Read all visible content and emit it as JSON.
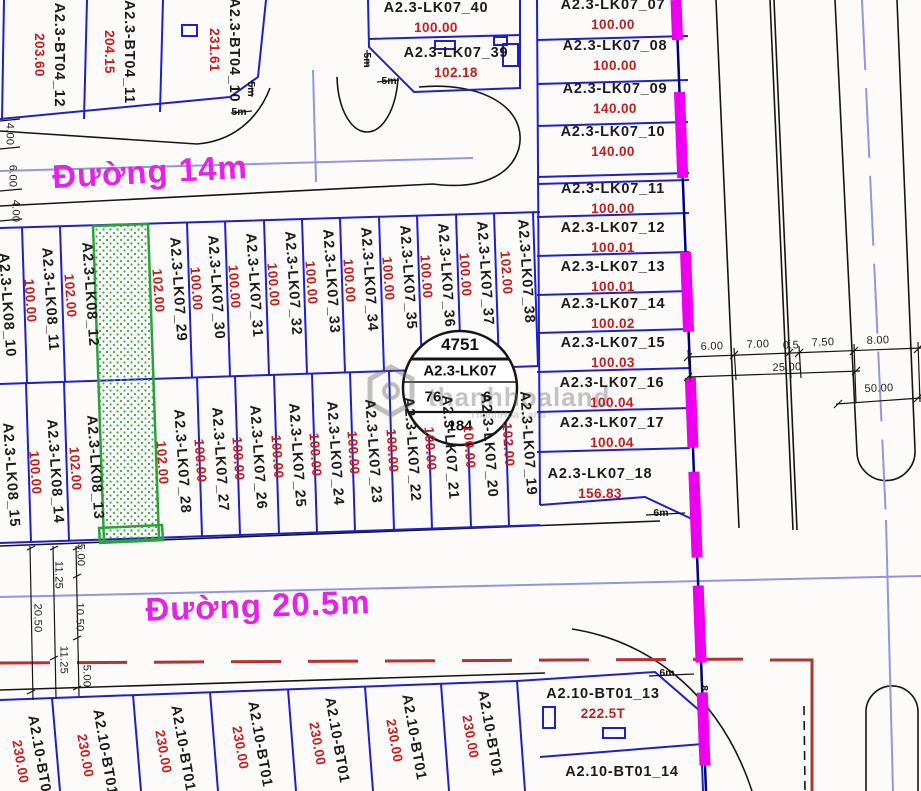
{
  "map": {
    "streets": {
      "road_14m": "Đường 14m",
      "road_20_5m": "Đường 20.5m"
    },
    "stamp": {
      "number": "4751",
      "block_name": "A2.3-LK07",
      "left_value": "76",
      "right_value": "6",
      "bottom_value": "184"
    },
    "watermark": {
      "main": "thanhhoaland",
      "sub": "ThanhHoa Land"
    },
    "colors": {
      "plot_line": "#2020c8",
      "area_text": "#c41e1e",
      "street_text": "#e424e4",
      "boundary_dash": "#ee00ee",
      "centerline": "#9595dd",
      "setback_line": "#b63232",
      "greenway": "#2aa23a"
    },
    "plot_labels": [
      {
        "label": "A2.3-BT04_12",
        "area": "203.60",
        "x": 49,
        "y": 55,
        "rot": 90
      },
      {
        "label": "A2.3-BT04_11",
        "area": "204.15",
        "x": 119,
        "y": 52,
        "rot": 90
      },
      {
        "label": "A2.3-BT04_10",
        "area": "231.61",
        "x": 224,
        "y": 50,
        "rot": 90
      },
      {
        "label": "A2.3-LK07_40",
        "area": "100.00",
        "x": 436,
        "y": 18,
        "rot": 0
      },
      {
        "label": "A2.3-LK07_39",
        "area": "102.18",
        "x": 456,
        "y": 63,
        "rot": 0
      },
      {
        "label": "A2.3-LK07_07",
        "area": "100.00",
        "x": 613,
        "y": 15,
        "rot": 0
      },
      {
        "label": "A2.3-LK07_08",
        "area": "100.00",
        "x": 615,
        "y": 56,
        "rot": 0
      },
      {
        "label": "A2.3-LK07_09",
        "area": "140.00",
        "x": 615,
        "y": 99,
        "rot": 0
      },
      {
        "label": "A2.3-LK07_10",
        "area": "140.00",
        "x": 613,
        "y": 142,
        "rot": 0
      },
      {
        "label": "A2.3-LK07_11",
        "area": "100.00",
        "x": 613,
        "y": 199,
        "rot": 0
      },
      {
        "label": "A2.3-LK07_12",
        "area": "100.01",
        "x": 613,
        "y": 238,
        "rot": 0
      },
      {
        "label": "A2.3-LK07_13",
        "area": "100.01",
        "x": 613,
        "y": 277,
        "rot": 0
      },
      {
        "label": "A2.3-LK07_14",
        "area": "100.02",
        "x": 613,
        "y": 314,
        "rot": 0
      },
      {
        "label": "A2.3-LK07_15",
        "area": "100.03",
        "x": 613,
        "y": 353,
        "rot": 0
      },
      {
        "label": "A2.3-LK07_16",
        "area": "100.04",
        "x": 612,
        "y": 393,
        "rot": 0
      },
      {
        "label": "A2.3-LK07_17",
        "area": "100.04",
        "x": 612,
        "y": 433,
        "rot": 0
      },
      {
        "label": "A2.3-LK07_18",
        "area": "156.83",
        "x": 600,
        "y": 484,
        "rot": 0
      },
      {
        "label": "A2.3-LK08_10",
        "area": "",
        "x": 6,
        "y": 305,
        "rot": 86
      },
      {
        "label": "A2.3-LK08_11",
        "area": "100.00",
        "x": 40,
        "y": 300,
        "rot": 86
      },
      {
        "label": "A2.3-LK08_12",
        "area": "102.00",
        "x": 80,
        "y": 295,
        "rot": 86
      },
      {
        "label": "A2.3-LK07_29",
        "area": "102.00",
        "x": 168,
        "y": 290,
        "rot": 86
      },
      {
        "label": "A2.3-LK07_30",
        "area": "100.00",
        "x": 206,
        "y": 288,
        "rot": 86
      },
      {
        "label": "A2.3-LK07_31",
        "area": "100.00",
        "x": 244,
        "y": 286,
        "rot": 86
      },
      {
        "label": "A2.3-LK07_32",
        "area": "100.00",
        "x": 283,
        "y": 284,
        "rot": 86
      },
      {
        "label": "A2.3-LK07_33",
        "area": "100.00",
        "x": 321,
        "y": 282,
        "rot": 86
      },
      {
        "label": "A2.3-LK07_34",
        "area": "100.00",
        "x": 359,
        "y": 280,
        "rot": 86
      },
      {
        "label": "A2.3-LK07_35",
        "area": "100.00",
        "x": 398,
        "y": 278,
        "rot": 86
      },
      {
        "label": "A2.3-LK07_36",
        "area": "100.00",
        "x": 436,
        "y": 276,
        "rot": 86
      },
      {
        "label": "A2.3-LK07_37",
        "area": "100.00",
        "x": 475,
        "y": 274,
        "rot": 86
      },
      {
        "label": "A2.3-LK07_38",
        "area": "102.00",
        "x": 516,
        "y": 272,
        "rot": 86
      },
      {
        "label": "A2.3-LK08_15",
        "area": "",
        "x": 10,
        "y": 475,
        "rot": 86
      },
      {
        "label": "A2.3-LK08_14",
        "area": "100.00",
        "x": 45,
        "y": 472,
        "rot": 86
      },
      {
        "label": "A2.3-LK08_13",
        "area": "102.00",
        "x": 85,
        "y": 468,
        "rot": 86
      },
      {
        "label": "A2.3-LK07_28",
        "area": "102.00",
        "x": 172,
        "y": 462,
        "rot": 86
      },
      {
        "label": "A2.3-LK07_27",
        "area": "100.00",
        "x": 210,
        "y": 460,
        "rot": 86
      },
      {
        "label": "A2.3-LK07_26",
        "area": "100.00",
        "x": 248,
        "y": 458,
        "rot": 86
      },
      {
        "label": "A2.3-LK07_25",
        "area": "100.00",
        "x": 287,
        "y": 456,
        "rot": 86
      },
      {
        "label": "A2.3-LK07_24",
        "area": "100.00",
        "x": 325,
        "y": 454,
        "rot": 86
      },
      {
        "label": "A2.3-LK07_23",
        "area": "100.00",
        "x": 363,
        "y": 452,
        "rot": 86
      },
      {
        "label": "A2.3-LK07_22",
        "area": "100.00",
        "x": 402,
        "y": 450,
        "rot": 86
      },
      {
        "label": "A2.3-LK07_21",
        "area": "100.00",
        "x": 440,
        "y": 448,
        "rot": 86
      },
      {
        "label": "A2.3-LK07_20",
        "area": "100.00",
        "x": 479,
        "y": 446,
        "rot": 86
      },
      {
        "label": "A2.3-LK07_19",
        "area": "102.00",
        "x": 518,
        "y": 444,
        "rot": 86
      },
      {
        "label": "A2.10-BT01",
        "area": "230.00",
        "x": 30,
        "y": 760,
        "rot": 80
      },
      {
        "label": "A2.10-BT01",
        "area": "230.00",
        "x": 95,
        "y": 754,
        "rot": 80
      },
      {
        "label": "A2.10-BT01",
        "area": "230.00",
        "x": 173,
        "y": 750,
        "rot": 80
      },
      {
        "label": "A2.10-BT01",
        "area": "230.00",
        "x": 250,
        "y": 746,
        "rot": 80
      },
      {
        "label": "A2.10-BT01",
        "area": "230.00",
        "x": 327,
        "y": 742,
        "rot": 80
      },
      {
        "label": "A2.10-BT01",
        "area": "230.00",
        "x": 404,
        "y": 739,
        "rot": 80
      },
      {
        "label": "A2.10-BT01",
        "area": "230.00",
        "x": 480,
        "y": 735,
        "rot": 80
      },
      {
        "label": "A2.10-BT01_13",
        "area": "222.5T",
        "x": 603,
        "y": 704,
        "rot": 0
      },
      {
        "label": "A2.10-BT01_14",
        "area": "",
        "x": 622,
        "y": 773,
        "rot": 0
      }
    ],
    "dimensions": [
      {
        "t": "4.00",
        "x": 9,
        "y": 134,
        "r": 90
      },
      {
        "t": "6.00",
        "x": 12,
        "y": 176,
        "r": 90
      },
      {
        "t": "4.00",
        "x": 15,
        "y": 211,
        "r": 90
      },
      {
        "t": "5.00",
        "x": 80,
        "y": 555,
        "r": 90
      },
      {
        "t": "11.25",
        "x": 58,
        "y": 575,
        "r": 90
      },
      {
        "t": "10.50",
        "x": 79,
        "y": 617,
        "r": 90
      },
      {
        "t": "20.50",
        "x": 37,
        "y": 618,
        "r": 90
      },
      {
        "t": "11.25",
        "x": 63,
        "y": 660,
        "r": 90
      },
      {
        "t": "5.00",
        "x": 86,
        "y": 676,
        "r": 90
      },
      {
        "t": "6.00",
        "x": 712,
        "y": 347,
        "r": -2
      },
      {
        "t": "7.00",
        "x": 758,
        "y": 345,
        "r": -2
      },
      {
        "t": "0.5",
        "x": 791,
        "y": 346,
        "r": -2
      },
      {
        "t": "7.50",
        "x": 823,
        "y": 343,
        "r": -2
      },
      {
        "t": "8.00",
        "x": 878,
        "y": 341,
        "r": -2
      },
      {
        "t": "25.00",
        "x": 787,
        "y": 368,
        "r": -2
      },
      {
        "t": "50.00",
        "x": 879,
        "y": 389,
        "r": -2
      }
    ],
    "notes": [
      {
        "t": "5m",
        "x": 251,
        "y": 89,
        "r": 90
      },
      {
        "t": "5m",
        "x": 239,
        "y": 112,
        "r": 0
      },
      {
        "t": "5m",
        "x": 367,
        "y": 60,
        "r": 90
      },
      {
        "t": "5m",
        "x": 389,
        "y": 81,
        "r": 0
      },
      {
        "t": "6m",
        "x": 661,
        "y": 513,
        "r": 0
      },
      {
        "t": "6m",
        "x": 667,
        "y": 673,
        "r": 0
      },
      {
        "t": "8",
        "x": 704,
        "y": 688,
        "r": 90
      }
    ]
  }
}
